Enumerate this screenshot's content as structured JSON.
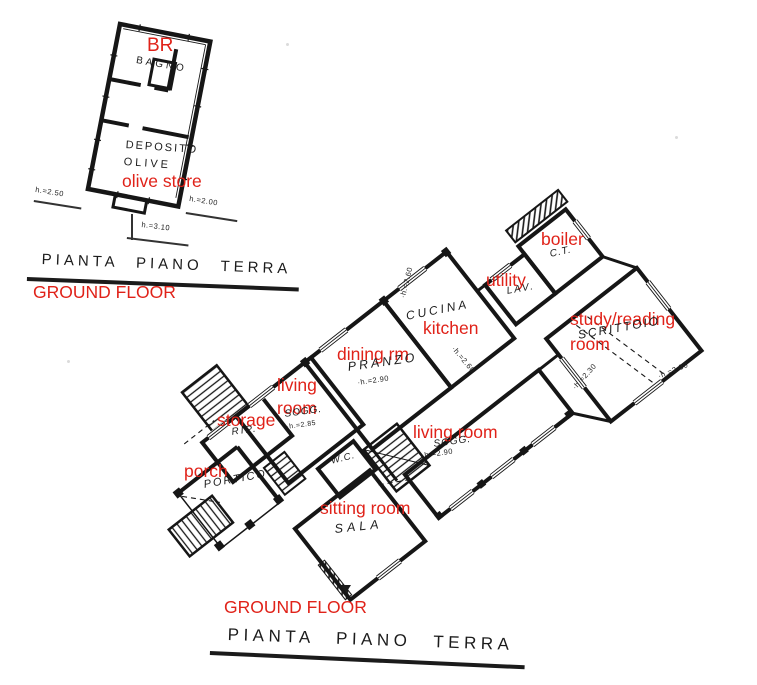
{
  "colors": {
    "paper": "#ffffff",
    "ink": "#1b1b1b",
    "annotation_red": "#e02219"
  },
  "upper_plan": {
    "rooms": {
      "bagno": "BAGNO",
      "deposito_line1": "DEPOSITO",
      "deposito_line2": "OLIVE"
    },
    "annotations": {
      "bathroom": "BR",
      "olive_store": "olive store"
    },
    "heights": {
      "left": "h.=2.50",
      "right": "h.=2.00",
      "bottom": "h.=3.10"
    },
    "caption": {
      "title": "PIANTA PIANO TERRA",
      "translation": "GROUND FLOOR"
    }
  },
  "main_plan": {
    "rooms": {
      "boiler_room": "C.T.",
      "laundry": "LAV.",
      "kitchen": "CUCINA",
      "study": "SCRITTOIO",
      "dining": "PRANZO",
      "living_small": "SOGG.",
      "storage": "RIP.",
      "living_large": "SOGG.",
      "porch": "PORTICO",
      "wc": "W.C.",
      "sitting": "SALA"
    },
    "annotations": {
      "boiler": "boiler",
      "utility": "utility",
      "kitchen": "kitchen",
      "study_line1": "study/reading",
      "study_line2": "room",
      "dining": "dining rm",
      "living_line1": "living",
      "living_line2": "room",
      "storage": "storage",
      "living_room": "living room",
      "porch": "porch",
      "sitting_room": "sitting room"
    },
    "heights": {
      "dining": "·h.=2.90",
      "living_small": "·h.=2.85",
      "living_large": "·h.=2.90",
      "kitchen_wall": "·h.=2.60",
      "hall": "·h.=2.60",
      "study_left": "·h.=2.30",
      "study_right": "·h.=2.30"
    },
    "caption": {
      "translation": "GROUND FLOOR",
      "title": "PIANTA PIANO TERRA"
    }
  }
}
